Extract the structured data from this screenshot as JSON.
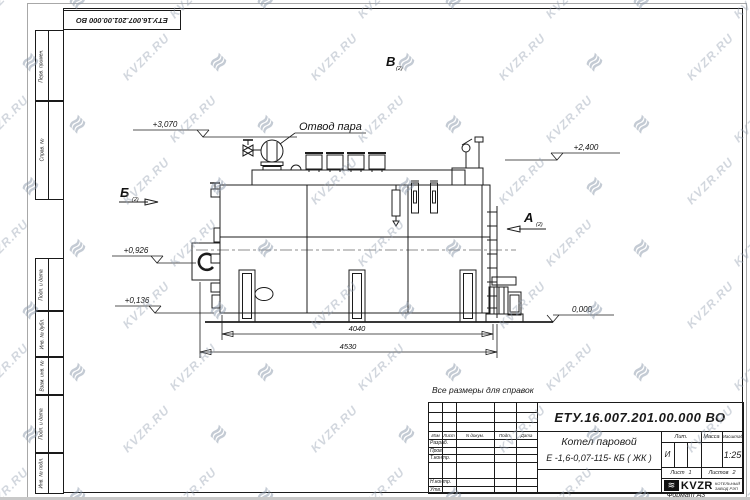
{
  "watermark": {
    "text": "KVZR.RU",
    "icon_glyph": "≋"
  },
  "corner_stamp": "ЕТУ.16.007.201.00.000  ВО",
  "margin_boxes": {
    "b1": "Перв. примен.",
    "b2": "Справ. №",
    "b3": "Подп. и дата",
    "b4": "Инв. № дубл.",
    "b5": "Взам. инв. №",
    "b6": "Подп. и дата",
    "b7": "Инв. № подл."
  },
  "drawing": {
    "steam_outlet_label": "Отвод пара",
    "elevations": {
      "e1": "+3,070",
      "e2": "+2,400",
      "e3": "+0,926",
      "e4": "+0,136",
      "e5": "0,000"
    },
    "dimensions": {
      "body": "4040",
      "overall": "4530"
    },
    "views": {
      "a": "А",
      "b": "Б",
      "v": "В",
      "sheet_ref": "(2)"
    }
  },
  "note": "Все размеры для справок",
  "title_block": {
    "doc_number": "ЕТУ.16.007.201.00.000  ВО",
    "product_name": "Котел паровой",
    "product_type": "Е -1,6-0,07-115- КБ ( ЖК )",
    "columns": {
      "izm": "Изм",
      "list": "Лист",
      "doc": "N докум.",
      "podp": "Подп.",
      "data": "Дата"
    },
    "rows": {
      "r1": "Разраб.",
      "r2": "Пров.",
      "r3": "Т.контр.",
      "r4": "Н.контр.",
      "r5": "Утв."
    },
    "lit_header": "Лит.",
    "mass_header": "Масса",
    "scale_header": "Масштаб",
    "lit_value": "И",
    "scale_value": "1:25",
    "sheet_label": "Лист",
    "sheet_value": "1",
    "sheets_label": "Листов",
    "sheets_value": "2",
    "company_name": "KVZR",
    "company_line1": "КОТЕЛЬНЫЙ",
    "company_line2": "ЗАВОД РЭП",
    "format_label": "Формат А3"
  }
}
